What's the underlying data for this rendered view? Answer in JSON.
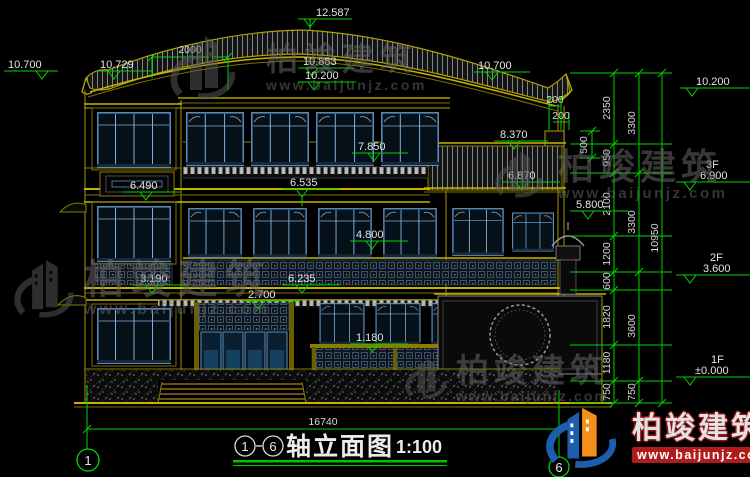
{
  "drawing": {
    "title": "轴立面图",
    "scale": "1:100",
    "axis_from": "1",
    "axis_to": "6"
  },
  "brand": {
    "name": "柏竣建筑",
    "url": "www.baijunjz.com"
  },
  "elevations": {
    "ridge": "12.587",
    "eave_left": "10.700",
    "eave_left_inner": "10.729",
    "ridge_lower": "10.853",
    "ridge_base": "10.200",
    "eave_right": "10.700",
    "parapet_right": "10.200",
    "wing_roof": "8.370",
    "sill_3f": "7.850",
    "band_3f": "6.535",
    "tower_band": "6.490",
    "wing_eave": "6.870",
    "wing_floor": "5.800",
    "sill_2f": "4.800",
    "band_2f": "6.235",
    "canopy_1f": "2.700",
    "railing_1f": "1.180",
    "tower_low": "3.190",
    "floor3_label": "3F",
    "floor3": "6.900",
    "floor2_label": "2F",
    "floor2": "3.600",
    "floor1_label": "1F",
    "floor1": "±0.000"
  },
  "dimensions": {
    "top_offset": "2000",
    "parapet_a": "200",
    "parapet_b": "200",
    "parapet_h": "500",
    "chain_inner": [
      "2350",
      "950",
      "2100",
      "1200",
      "600",
      "1820",
      "1180",
      "750"
    ],
    "chain_mid": [
      "3300",
      "3300",
      "3600",
      "750"
    ],
    "chain_overall": "10950",
    "total_width": "16740"
  },
  "colors": {
    "dim_green": "#00d400",
    "line_yellow": "#b0a000",
    "window_blue": "#5b8fc4",
    "text": "#e4e4e4",
    "logo_blue": "#1d5dad",
    "logo_orange": "#f39019",
    "logo_red": "#b01c1c",
    "watermark_gray": "#666666"
  }
}
